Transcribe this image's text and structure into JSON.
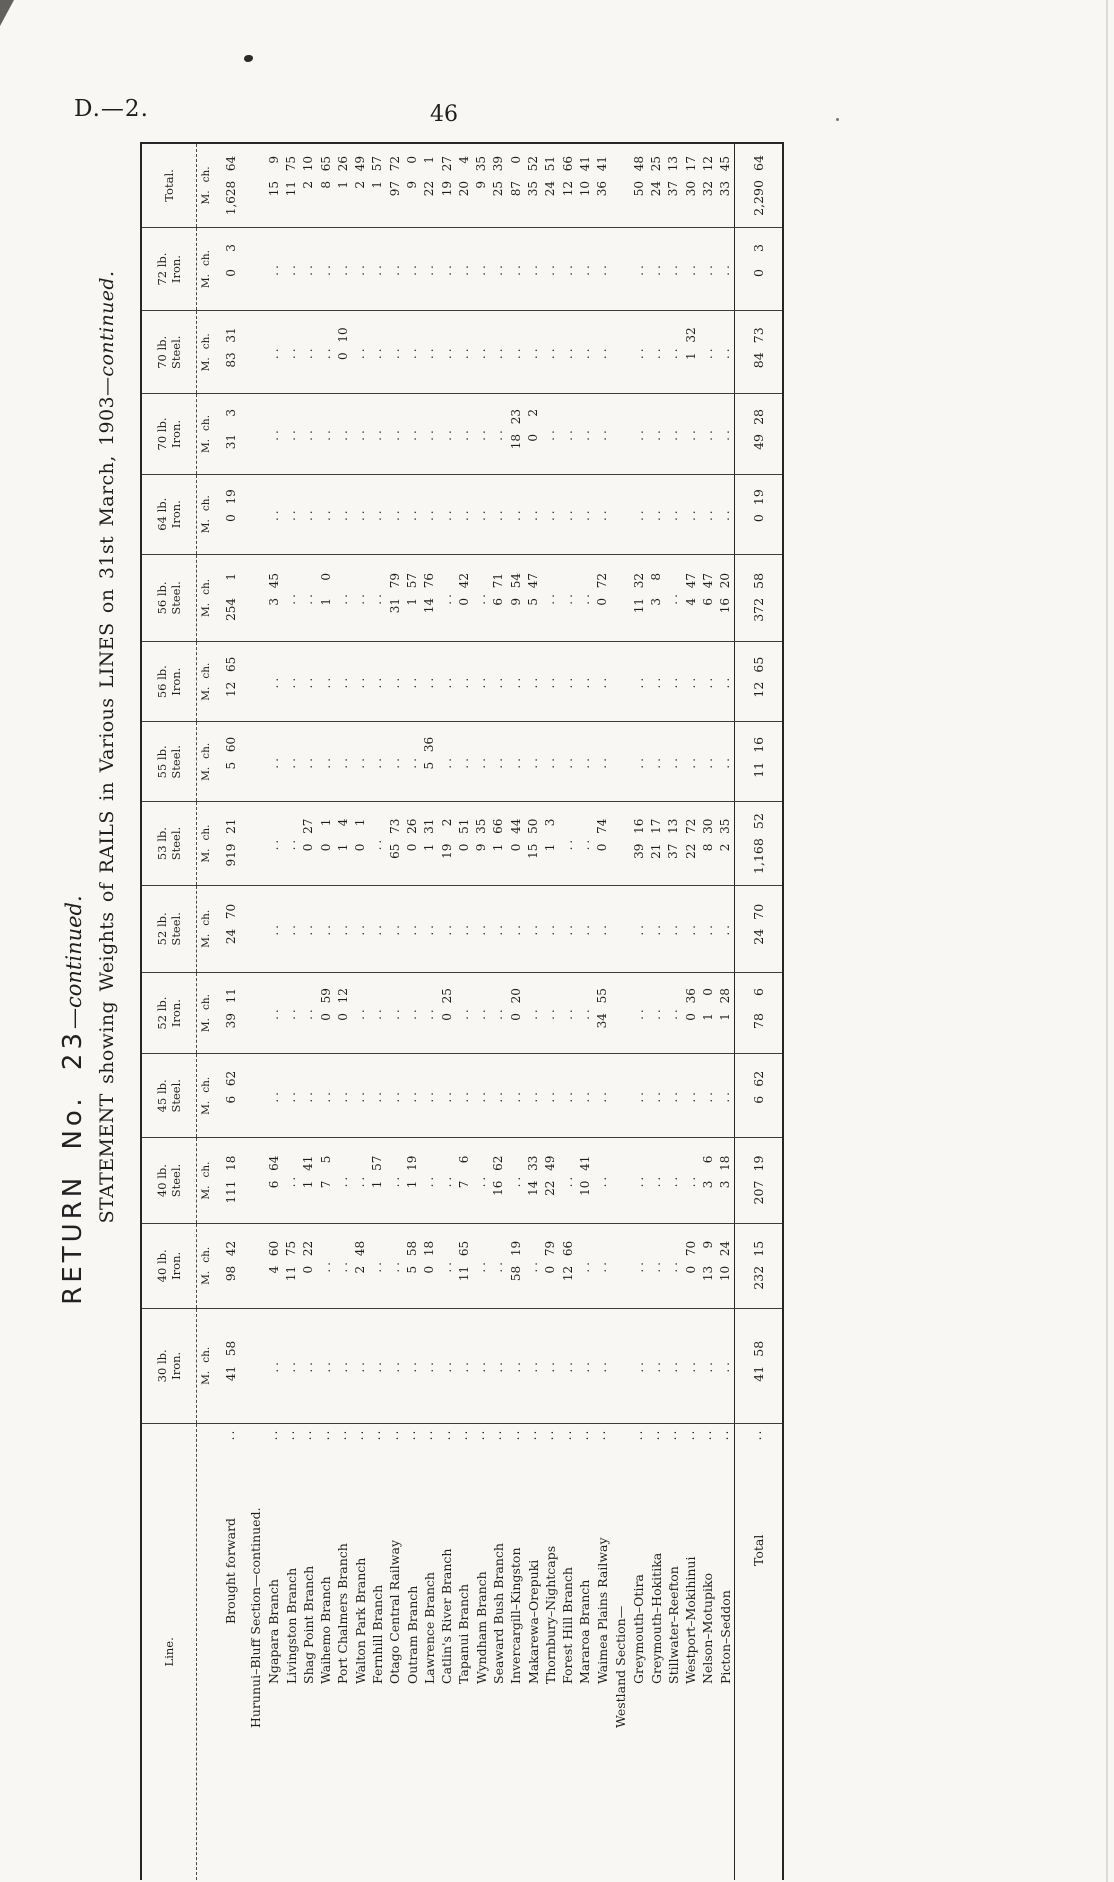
{
  "page": {
    "doc_ref": "D.—2.",
    "page_number": "46"
  },
  "titles": {
    "return_main": "RETURN No. 23",
    "return_continued": "—continued.",
    "statement_main": "STATEMENT showing Weights of RAILS in Various LINES on 31st March, 1903",
    "statement_continued": "—continued."
  },
  "table": {
    "line_header": "Line.",
    "total_header": "Total.",
    "unit_miles": "M.",
    "unit_chains": "ch.",
    "nil_symbol": "..",
    "leader": "..",
    "columns": [
      {
        "weight": "30 lb.",
        "material": "Iron."
      },
      {
        "weight": "40 lb.",
        "material": "Iron."
      },
      {
        "weight": "40 lb.",
        "material": "Steel."
      },
      {
        "weight": "45 lb.",
        "material": "Steel."
      },
      {
        "weight": "52 lb.",
        "material": "Iron."
      },
      {
        "weight": "52 lb.",
        "material": "Steel."
      },
      {
        "weight": "53 lb.",
        "material": "Steel."
      },
      {
        "weight": "55 lb.",
        "material": "Steel."
      },
      {
        "weight": "56 lb.",
        "material": "Iron."
      },
      {
        "weight": "56 lb.",
        "material": "Steel."
      },
      {
        "weight": "64 lb.",
        "material": "Iron."
      },
      {
        "weight": "70 lb.",
        "material": "Iron."
      },
      {
        "weight": "70 lb.",
        "material": "Steel."
      },
      {
        "weight": "72 lb.",
        "material": "Iron."
      }
    ],
    "rows": [
      {
        "type": "carry",
        "name": "Brought forward",
        "values": [
          "41 58",
          "98 42",
          "111 18",
          "6 62",
          "39 11",
          "24 70",
          "919 21",
          "5 60",
          "12 65",
          "254 1",
          "0 19",
          "31 3",
          "83 31",
          "0 3"
        ],
        "total": "1,628 64"
      },
      {
        "type": "section",
        "name": "Hurunui–Bluff Section—continued."
      },
      {
        "type": "line",
        "name": "Ngapara Branch",
        "values": [
          null,
          "4 60",
          "6 64",
          null,
          null,
          null,
          null,
          null,
          null,
          "3 45",
          null,
          null,
          null,
          null
        ],
        "total": "15 9"
      },
      {
        "type": "line",
        "name": "Livingston Branch",
        "values": [
          null,
          "11 75",
          null,
          null,
          null,
          null,
          null,
          null,
          null,
          null,
          null,
          null,
          null,
          null
        ],
        "total": "11 75"
      },
      {
        "type": "line",
        "name": "Shag Point Branch",
        "values": [
          null,
          "0 22",
          "1 41",
          null,
          null,
          null,
          "0 27",
          null,
          null,
          null,
          null,
          null,
          null,
          null
        ],
        "total": "2 10"
      },
      {
        "type": "line",
        "name": "Waihemo Branch",
        "values": [
          null,
          null,
          "7 5",
          null,
          "0 59",
          null,
          "0 1",
          null,
          null,
          "1 0",
          null,
          null,
          null,
          null
        ],
        "total": "8 65"
      },
      {
        "type": "line",
        "name": "Port Chalmers Branch",
        "values": [
          null,
          null,
          null,
          null,
          "0 12",
          null,
          "1 4",
          null,
          null,
          null,
          null,
          null,
          "0 10",
          null
        ],
        "total": "1 26"
      },
      {
        "type": "line",
        "name": "Walton Park Branch",
        "values": [
          null,
          "2 48",
          null,
          null,
          null,
          null,
          "0 1",
          null,
          null,
          null,
          null,
          null,
          null,
          null
        ],
        "total": "2 49"
      },
      {
        "type": "line",
        "name": "Fernhill Branch",
        "values": [
          null,
          null,
          "1 57",
          null,
          null,
          null,
          null,
          null,
          null,
          null,
          null,
          null,
          null,
          null
        ],
        "total": "1 57"
      },
      {
        "type": "line",
        "name": "Otago Central Railway",
        "values": [
          null,
          null,
          null,
          null,
          null,
          null,
          "65 73",
          null,
          null,
          "31 79",
          null,
          null,
          null,
          null
        ],
        "total": "97 72"
      },
      {
        "type": "line",
        "name": "Outram Branch",
        "values": [
          null,
          "5 58",
          "1 19",
          null,
          null,
          null,
          "0 26",
          null,
          null,
          "1 57",
          null,
          null,
          null,
          null
        ],
        "total": "9 0"
      },
      {
        "type": "line",
        "name": "Lawrence Branch",
        "values": [
          null,
          "0 18",
          null,
          null,
          null,
          null,
          "1 31",
          "5 36",
          null,
          "14 76",
          null,
          null,
          null,
          null
        ],
        "total": "22 1"
      },
      {
        "type": "line",
        "name": "Catlin's River Branch",
        "values": [
          null,
          null,
          null,
          null,
          "0 25",
          null,
          "19 2",
          null,
          null,
          null,
          null,
          null,
          null,
          null
        ],
        "total": "19 27"
      },
      {
        "type": "line",
        "name": "Tapanui Branch",
        "values": [
          null,
          "11 65",
          "7 6",
          null,
          null,
          null,
          "0 51",
          null,
          null,
          "0 42",
          null,
          null,
          null,
          null
        ],
        "total": "20 4"
      },
      {
        "type": "line",
        "name": "Wyndham Branch",
        "values": [
          null,
          null,
          null,
          null,
          null,
          null,
          "9 35",
          null,
          null,
          null,
          null,
          null,
          null,
          null
        ],
        "total": "9 35"
      },
      {
        "type": "line",
        "name": "Seaward Bush Branch",
        "values": [
          null,
          null,
          "16 62",
          null,
          null,
          null,
          "1 66",
          null,
          null,
          "6 71",
          null,
          null,
          null,
          null
        ],
        "total": "25 39"
      },
      {
        "type": "line",
        "name": "Invercargill–Kingston",
        "values": [
          null,
          "58 19",
          null,
          null,
          "0 20",
          null,
          "0 44",
          null,
          null,
          "9 54",
          null,
          "18 23",
          null,
          null
        ],
        "total": "87 0"
      },
      {
        "type": "line",
        "name": "Makarewa–Orepuki",
        "values": [
          null,
          null,
          "14 33",
          null,
          null,
          null,
          "15 50",
          null,
          null,
          "5 47",
          null,
          "0 2",
          null,
          null
        ],
        "total": "35 52"
      },
      {
        "type": "line",
        "name": "Thornbury–Nightcaps",
        "values": [
          null,
          "0 79",
          "22 49",
          null,
          null,
          null,
          "1 3",
          null,
          null,
          null,
          null,
          null,
          null,
          null
        ],
        "total": "24 51"
      },
      {
        "type": "line",
        "name": "Forest Hill Branch",
        "values": [
          null,
          "12 66",
          null,
          null,
          null,
          null,
          null,
          null,
          null,
          null,
          null,
          null,
          null,
          null
        ],
        "total": "12 66"
      },
      {
        "type": "line",
        "name": "Mararoa Branch",
        "values": [
          null,
          null,
          "10 41",
          null,
          null,
          null,
          null,
          null,
          null,
          null,
          null,
          null,
          null,
          null
        ],
        "total": "10 41"
      },
      {
        "type": "line",
        "name": "Waimea Plains Railway",
        "values": [
          null,
          null,
          null,
          null,
          "34 55",
          null,
          "0 74",
          null,
          null,
          "0 72",
          null,
          null,
          null,
          null
        ],
        "total": "36 41"
      },
      {
        "type": "section",
        "name": "Westland Section—"
      },
      {
        "type": "line",
        "name": "Greymouth–Otira",
        "values": [
          null,
          null,
          null,
          null,
          null,
          null,
          "39 16",
          null,
          null,
          "11 32",
          null,
          null,
          null,
          null
        ],
        "total": "50 48"
      },
      {
        "type": "line",
        "name": "Greymouth–Hokitika",
        "values": [
          null,
          null,
          null,
          null,
          null,
          null,
          "21 17",
          null,
          null,
          "3 8",
          null,
          null,
          null,
          null
        ],
        "total": "24 25"
      },
      {
        "type": "line",
        "name": "Stillwater–Reefton",
        "values": [
          null,
          null,
          null,
          null,
          null,
          null,
          "37 13",
          null,
          null,
          null,
          null,
          null,
          null,
          null
        ],
        "total": "37 13"
      },
      {
        "type": "line",
        "name": "Westport–Mokihinui",
        "values": [
          null,
          "0 70",
          null,
          null,
          "0 36",
          null,
          "22 72",
          null,
          null,
          "4 47",
          null,
          null,
          "1 32",
          null
        ],
        "total": "30 17"
      },
      {
        "type": "line",
        "name": "Nelson–Motupiko",
        "values": [
          null,
          "13 9",
          "3 6",
          null,
          "1 0",
          null,
          "8 30",
          null,
          null,
          "6 47",
          null,
          null,
          null,
          null
        ],
        "total": "32 12"
      },
      {
        "type": "line",
        "name": "Picton–Seddon",
        "values": [
          null,
          "10 24",
          "3 18",
          null,
          "1 28",
          null,
          "2 35",
          null,
          null,
          "16 20",
          null,
          null,
          null,
          null
        ],
        "total": "33 45"
      },
      {
        "type": "total",
        "name": "Total",
        "values": [
          "41 58",
          "232 15",
          "207 19",
          "6 62",
          "78 6",
          "24 70",
          "1,168 52",
          "11 16",
          "12 65",
          "372 58",
          "0 19",
          "49 28",
          "84 73",
          "0 3"
        ],
        "total": "2,290 64"
      }
    ]
  }
}
